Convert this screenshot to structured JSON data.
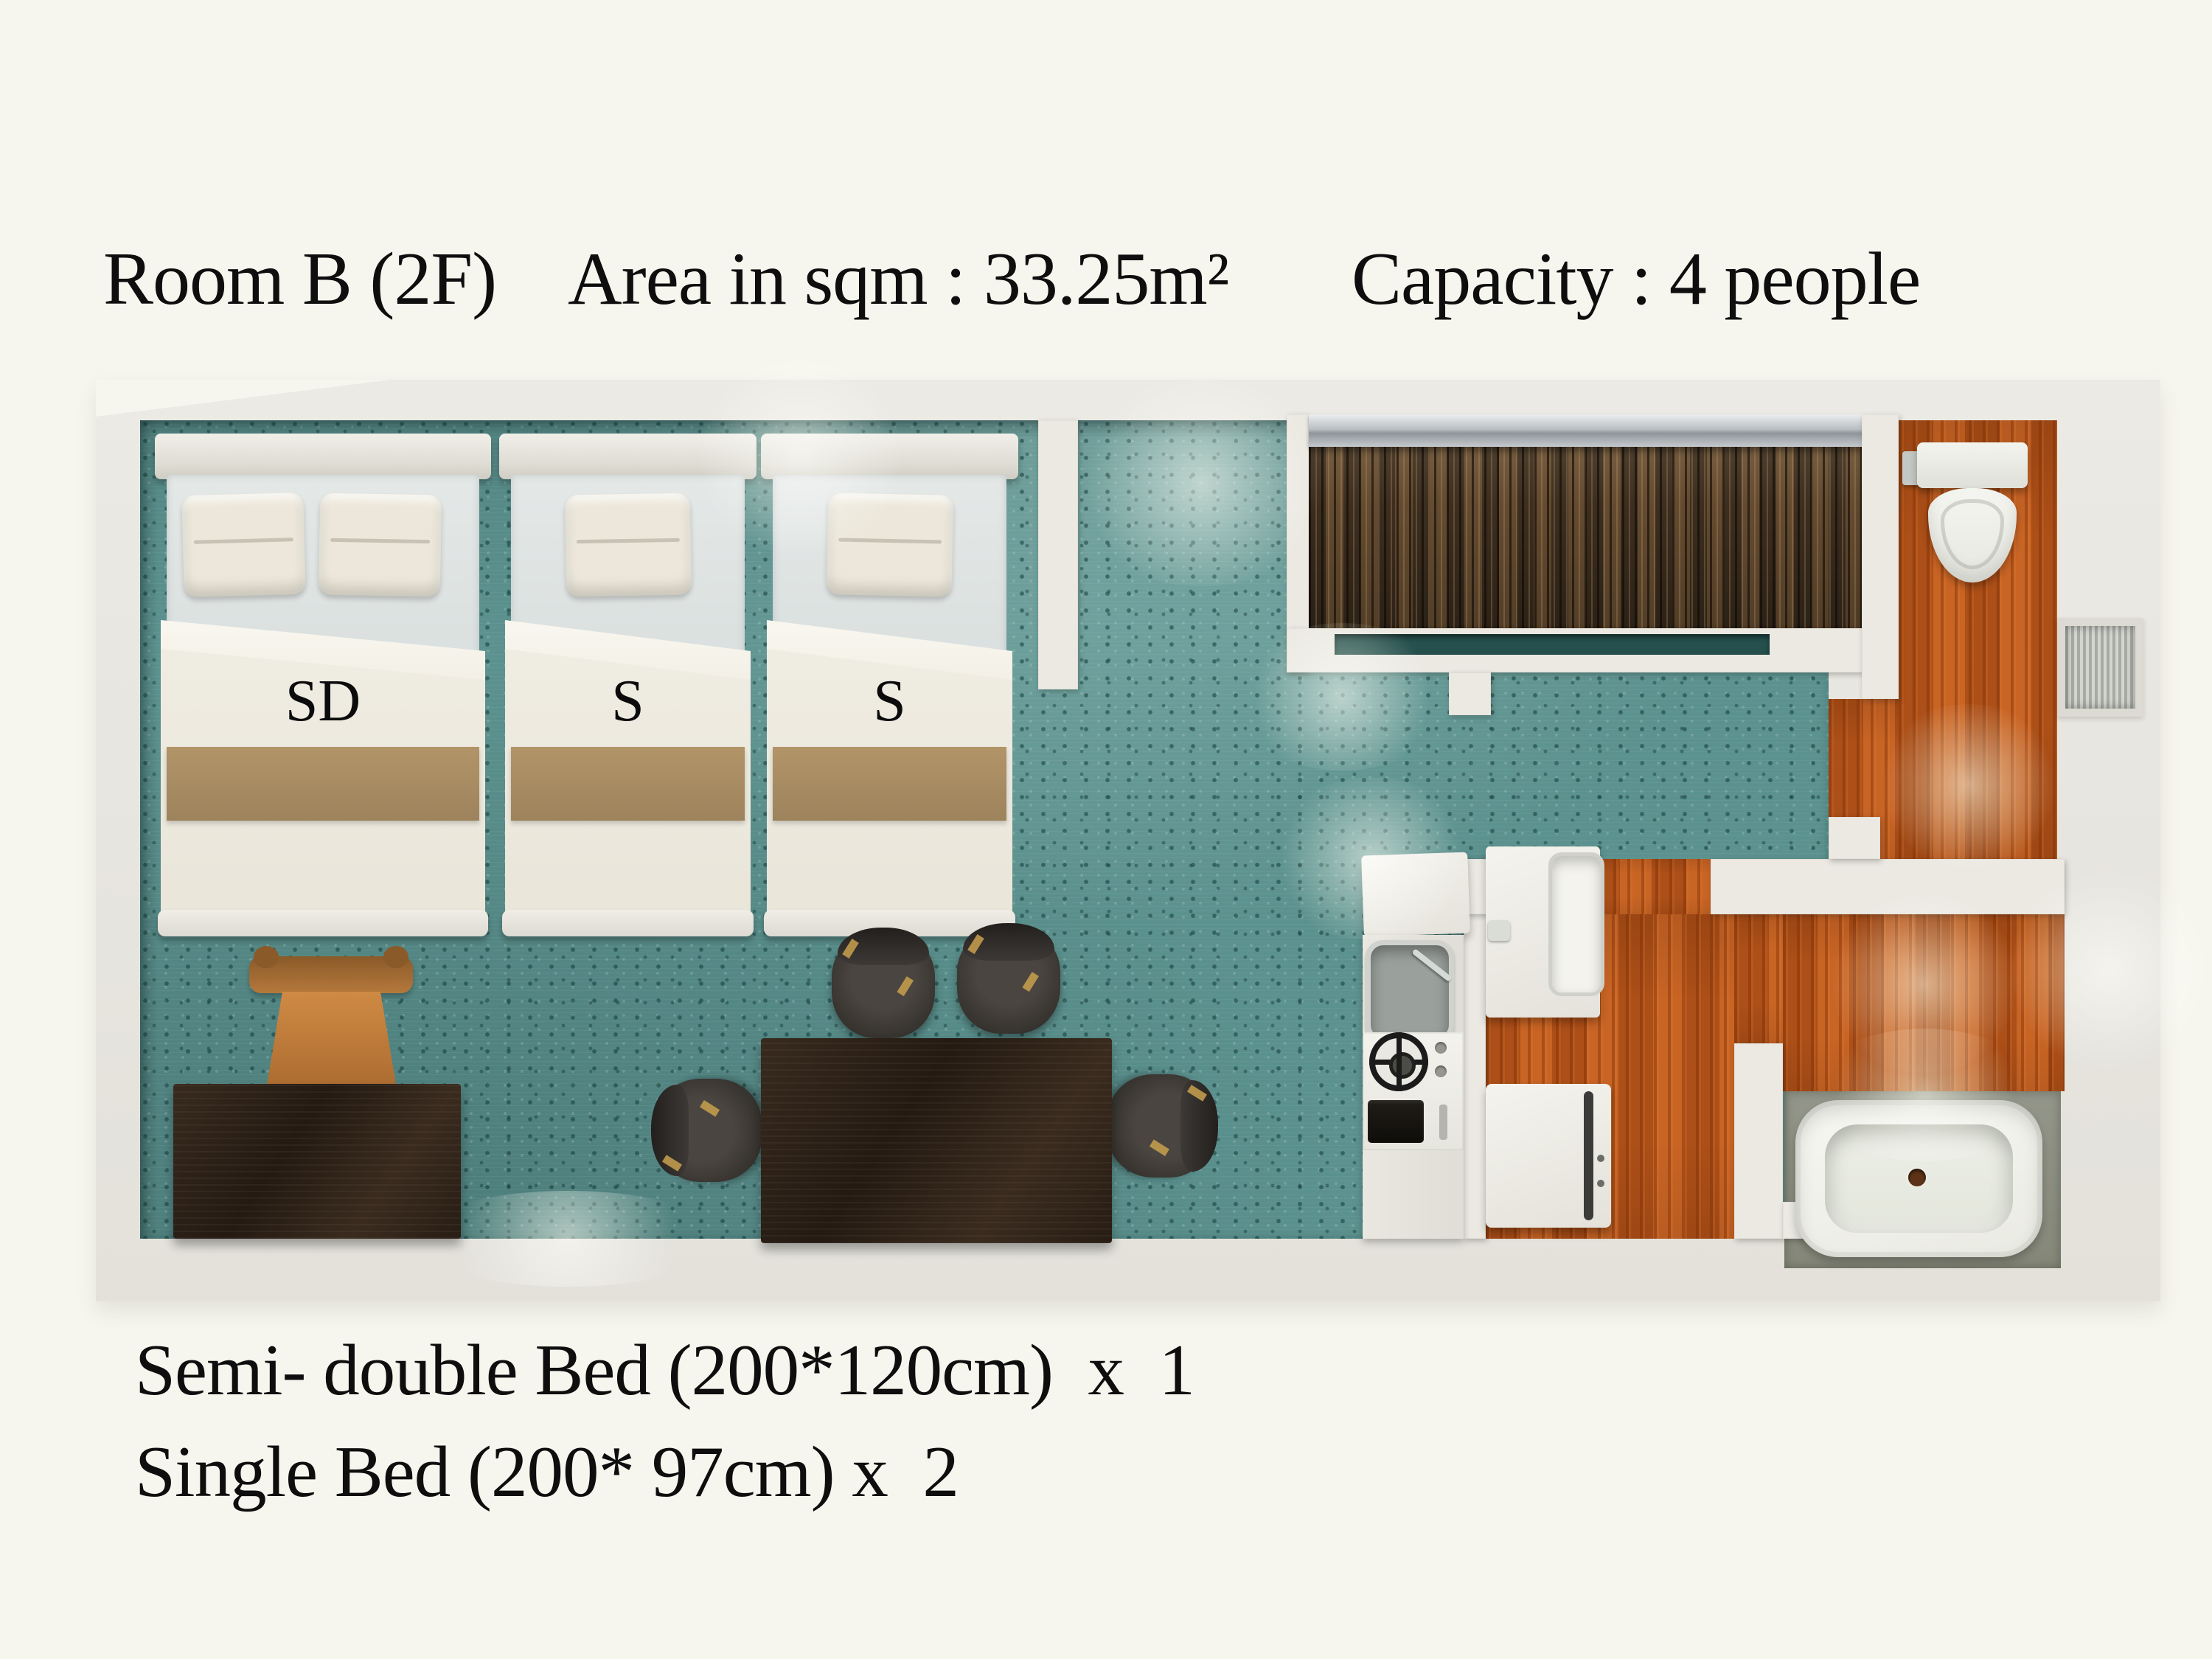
{
  "header": {
    "room": "Room B (2F)",
    "area": "Area in sqm : 33.25m²",
    "capacity": "Capacity : 4 people"
  },
  "floorplan": {
    "bed_labels": [
      "SD",
      "S",
      "S"
    ],
    "colors": {
      "background": "#f7f6ee",
      "carpet": "#5b918e",
      "wood_floor": "#c05a1d",
      "closet_wood": "#54402b",
      "wall": "#ebe9e2",
      "bed_runner": "#a98e63",
      "furniture_dark": "#2b2017"
    }
  },
  "legend": {
    "line1": "Semi- double Bed (200*120cm)  x  1",
    "line2": "Single Bed (200* 97cm) x  2"
  }
}
